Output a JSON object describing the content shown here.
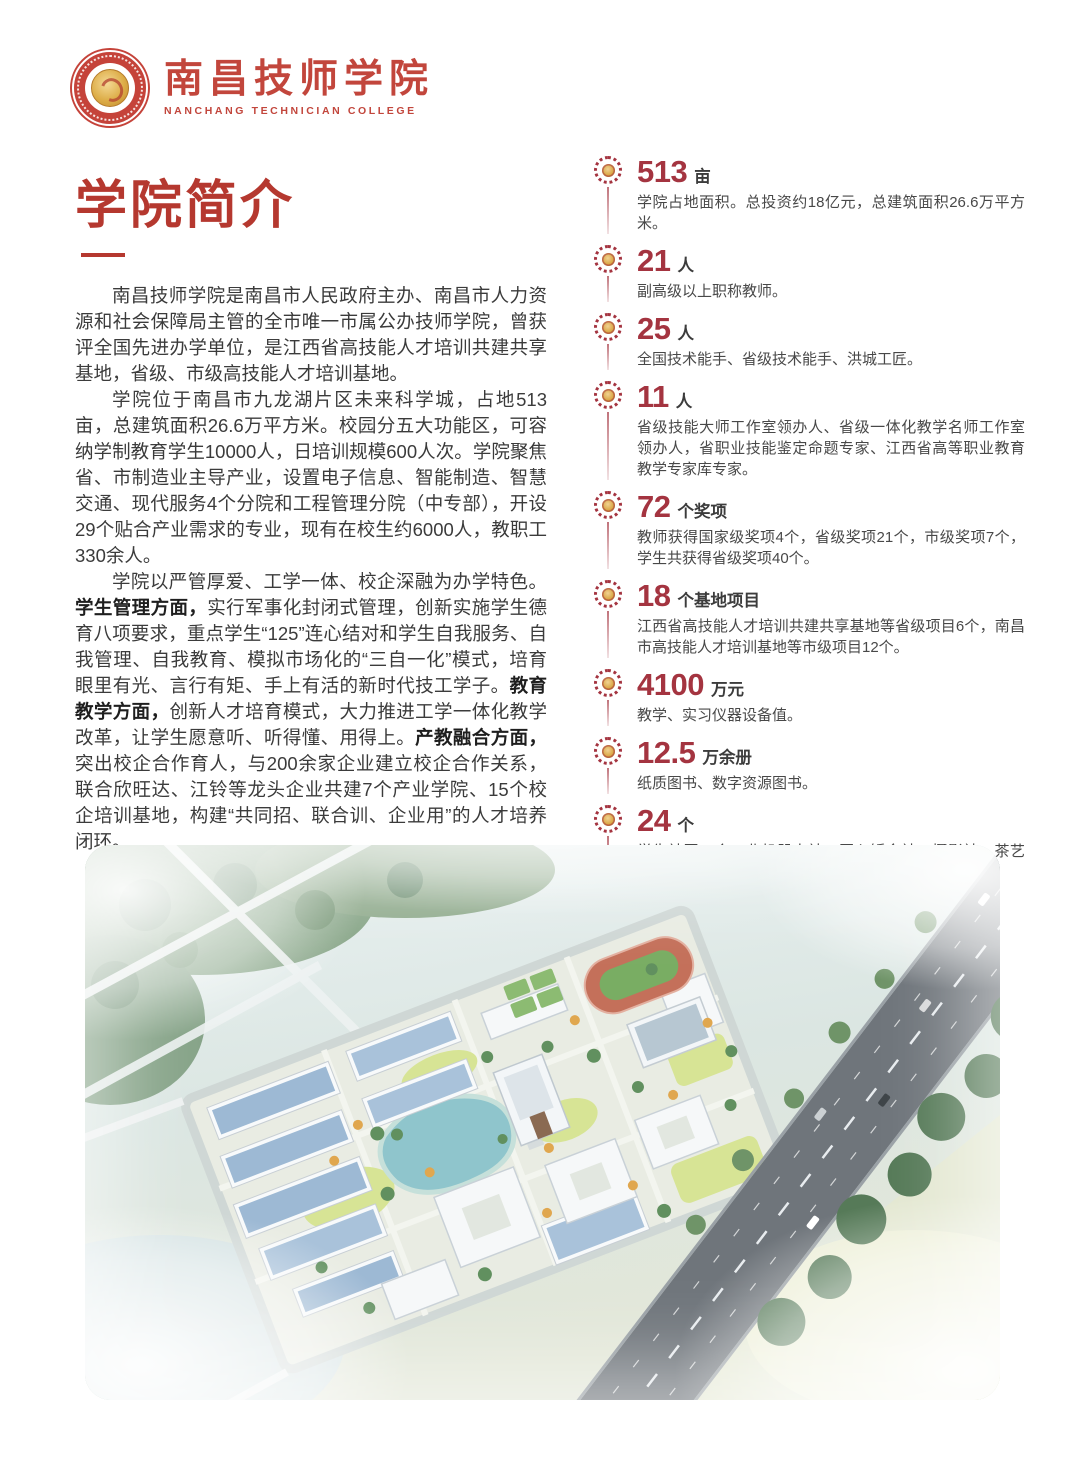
{
  "header": {
    "logo_cn": "南昌技师学院",
    "logo_en": "NANCHANG TECHNICIAN COLLEGE"
  },
  "intro": {
    "title": "学院简介",
    "paragraphs": [
      [
        {
          "text": "南昌技师学院是南昌市人民政府主办、南昌市人力资源和社会保障局主管的全市唯一市属公办技师学院，曾获评全国先进办学单位，是江西省高技能人才培训共建共享基地，省级、市级高技能人才培训基地。"
        }
      ],
      [
        {
          "text": "学院位于南昌市九龙湖片区未来科学城，占地513亩，总建筑面积26.6万平方米。校园分五大功能区，可容纳学制教育学生10000人，日培训规模600人次。学院聚焦省、市制造业主导产业，设置电子信息、智能制造、智慧交通、现代服务4个分院和工程管理分院（中专部），开设29个贴合产业需求的专业，现有在校生约6000人，教职工330余人。"
        }
      ],
      [
        {
          "text": "学院以严管厚爱、工学一体、校企深融为办学特色。"
        },
        {
          "text": "学生管理方面，",
          "bold": true
        },
        {
          "text": "实行军事化封闭式管理，创新实施学生德育八项要求，重点学生“125”连心结对和学生自我服务、自我管理、自我教育、模拟市场化的“三自一化”模式，培育眼里有光、言行有矩、手上有活的新时代技工学子。"
        },
        {
          "text": "教育教学方面，",
          "bold": true
        },
        {
          "text": "创新人才培育模式，大力推进工学一体化教学改革，让学生愿意听、听得懂、用得上。"
        },
        {
          "text": "产教融合方面，",
          "bold": true
        },
        {
          "text": "突出校企合作育人，与200余家企业建立校企合作关系，联合欣旺达、江铃等龙头企业共建7个产业学院、15个校企培训基地，构建“共同招、联合训、企业用”的人才培养闭环。"
        }
      ]
    ]
  },
  "stats": [
    {
      "value": "513",
      "unit": "亩",
      "desc": "学院占地面积。总投资约18亿元，总建筑面积26.6万平方米。"
    },
    {
      "value": "21",
      "unit": "人",
      "desc": "副高级以上职称教师。"
    },
    {
      "value": "25",
      "unit": "人",
      "desc": "全国技术能手、省级技术能手、洪城工匠。"
    },
    {
      "value": "11",
      "unit": "人",
      "desc": "省级技能大师工作室领办人、省级一体化教学名师工作室领办人，省职业技能鉴定命题专家、江西省高等职业教育教学专家库专家。"
    },
    {
      "value": "72",
      "unit": "个奖项",
      "desc": "教师获得国家级奖项4个，省级奖项21个，市级奖项7个，学生共获得省级奖项40个。"
    },
    {
      "value": "18",
      "unit": "个基地项目",
      "desc": "江西省高技能人才培训共建共享基地等省级项目6个，南昌市高技能人才培训基地等市级项目12个。"
    },
    {
      "value": "4100",
      "unit": "万元",
      "desc": "教学、实习仪器设备值。"
    },
    {
      "value": "12.5",
      "unit": "万余册",
      "desc": "纸质图书、数字资源图书。"
    },
    {
      "value": "24",
      "unit": "个",
      "desc": "学生社团，含工业机器人社、匠心钣金社、摄影社、茶艺社、篮球社、话剧社等。"
    }
  ],
  "icons": {
    "logo": "college-seal-icon",
    "stat_badge": "rosette-badge-icon"
  },
  "colors": {
    "brand_red": "#c2463c",
    "title_red": "#b5382f",
    "stat_red": "#a43440",
    "body_text": "#3b3b3b",
    "desc_text": "#484848"
  }
}
